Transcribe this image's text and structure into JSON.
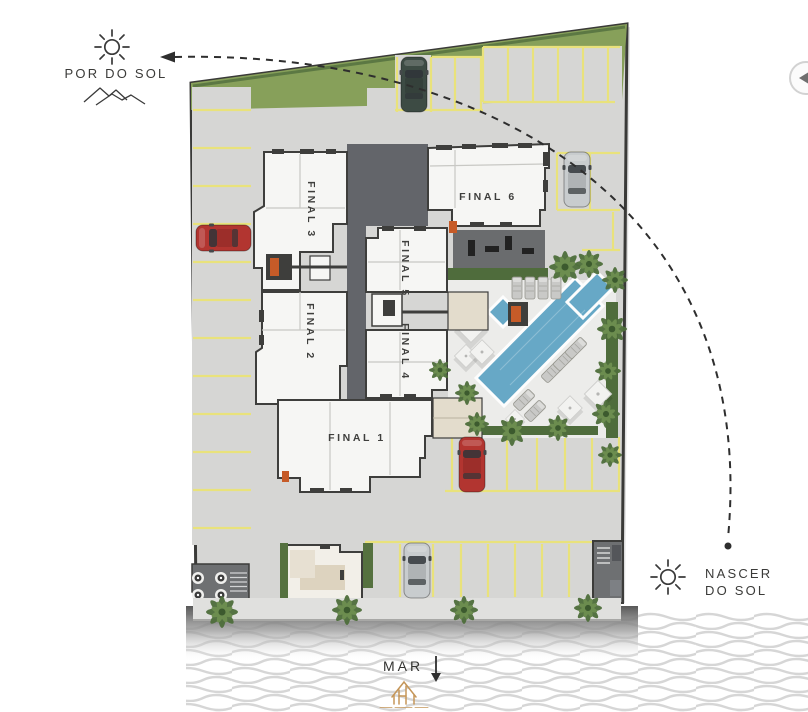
{
  "plan": {
    "compass": {
      "sunset_label": "POR DO SOL",
      "sunrise_label_line1": "NASCER",
      "sunrise_label_line2": "DO SOL",
      "sea_label": "MAR"
    },
    "units": [
      {
        "id": "final-1",
        "label": "FINAL 1"
      },
      {
        "id": "final-2",
        "label": "FINAL 2"
      },
      {
        "id": "final-3",
        "label": "FINAL 3"
      },
      {
        "id": "final-4",
        "label": "FINAL 4"
      },
      {
        "id": "final-5",
        "label": "FINAL 5"
      },
      {
        "id": "final-6",
        "label": "FINAL 6"
      }
    ],
    "features": {
      "pools_count": 3,
      "cars": [
        {
          "color": "dark-green",
          "location": "top-parking-row"
        },
        {
          "color": "silver",
          "location": "upper-right-parking"
        },
        {
          "color": "red",
          "location": "left-parking-column"
        },
        {
          "color": "red",
          "location": "center-parking-row"
        },
        {
          "color": "silver",
          "location": "bottom-parking-row"
        }
      ],
      "icons": {
        "sunset": "sun-icon",
        "sunset_secondary": "mountains-icon",
        "sunrise": "sun-icon",
        "sun_path": "dashed-arc-with-arrow",
        "sea_direction": "down-arrow-icon",
        "carousel": "prev-arrow-icon",
        "brand": "gold-house-logo-icon"
      }
    },
    "colors": {
      "pavement": "#d6d6d4",
      "pool_deck": "#ececea",
      "grass": "#87a05a",
      "hedge": "#4f6c3c",
      "pool_water": "#67a8c6",
      "parking_line": "#e9e27b",
      "building_fill": "#f6f6f4",
      "building_wall": "#3e3e3c",
      "core_fill": "#63656a",
      "accent_orange": "#c65b28",
      "car_red": "#b23530",
      "car_silver": "#c8ccce",
      "car_dark": "#3d4b44",
      "label_text": "#3b3b39",
      "logo_gold": "#c59659",
      "wave": "#d6d6d6"
    }
  }
}
